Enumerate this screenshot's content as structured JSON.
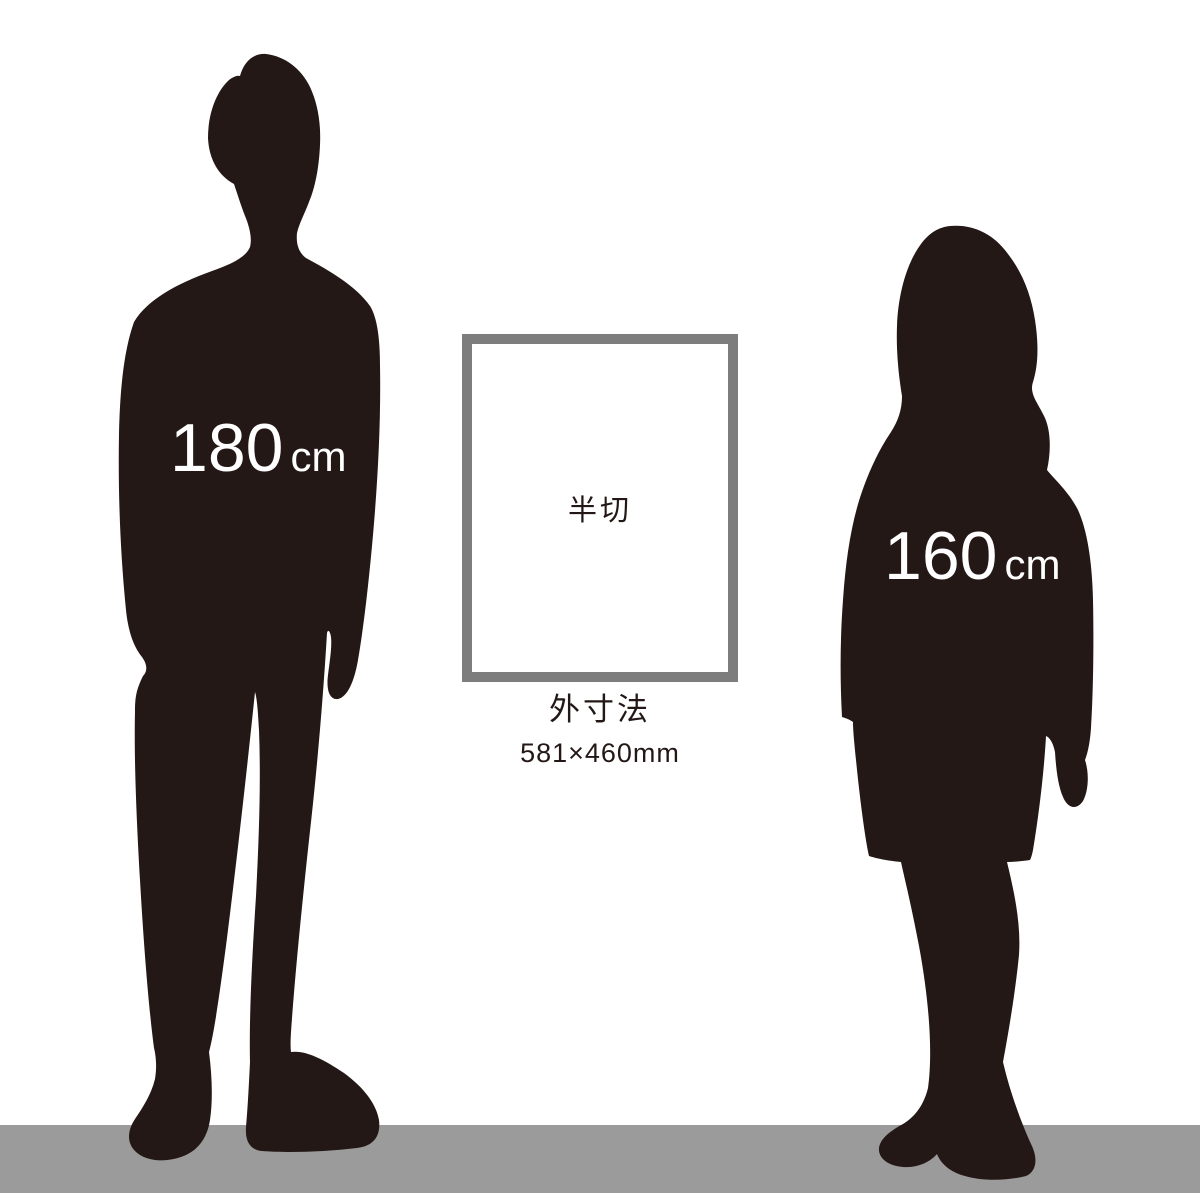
{
  "colors": {
    "background": "#ffffff",
    "silhouette": "#231815",
    "floor": "#9b9b9b",
    "frame_border": "#7d7d7d",
    "frame_fill": "#ffffff",
    "height_label_text": "#ffffff",
    "text_dark": "#231815"
  },
  "man": {
    "height_value": "180",
    "height_unit": "cm"
  },
  "woman": {
    "height_value": "160",
    "height_unit": "cm"
  },
  "frame": {
    "label": "半切"
  },
  "caption": {
    "title": "外寸法",
    "dimensions": "581×460mm"
  }
}
